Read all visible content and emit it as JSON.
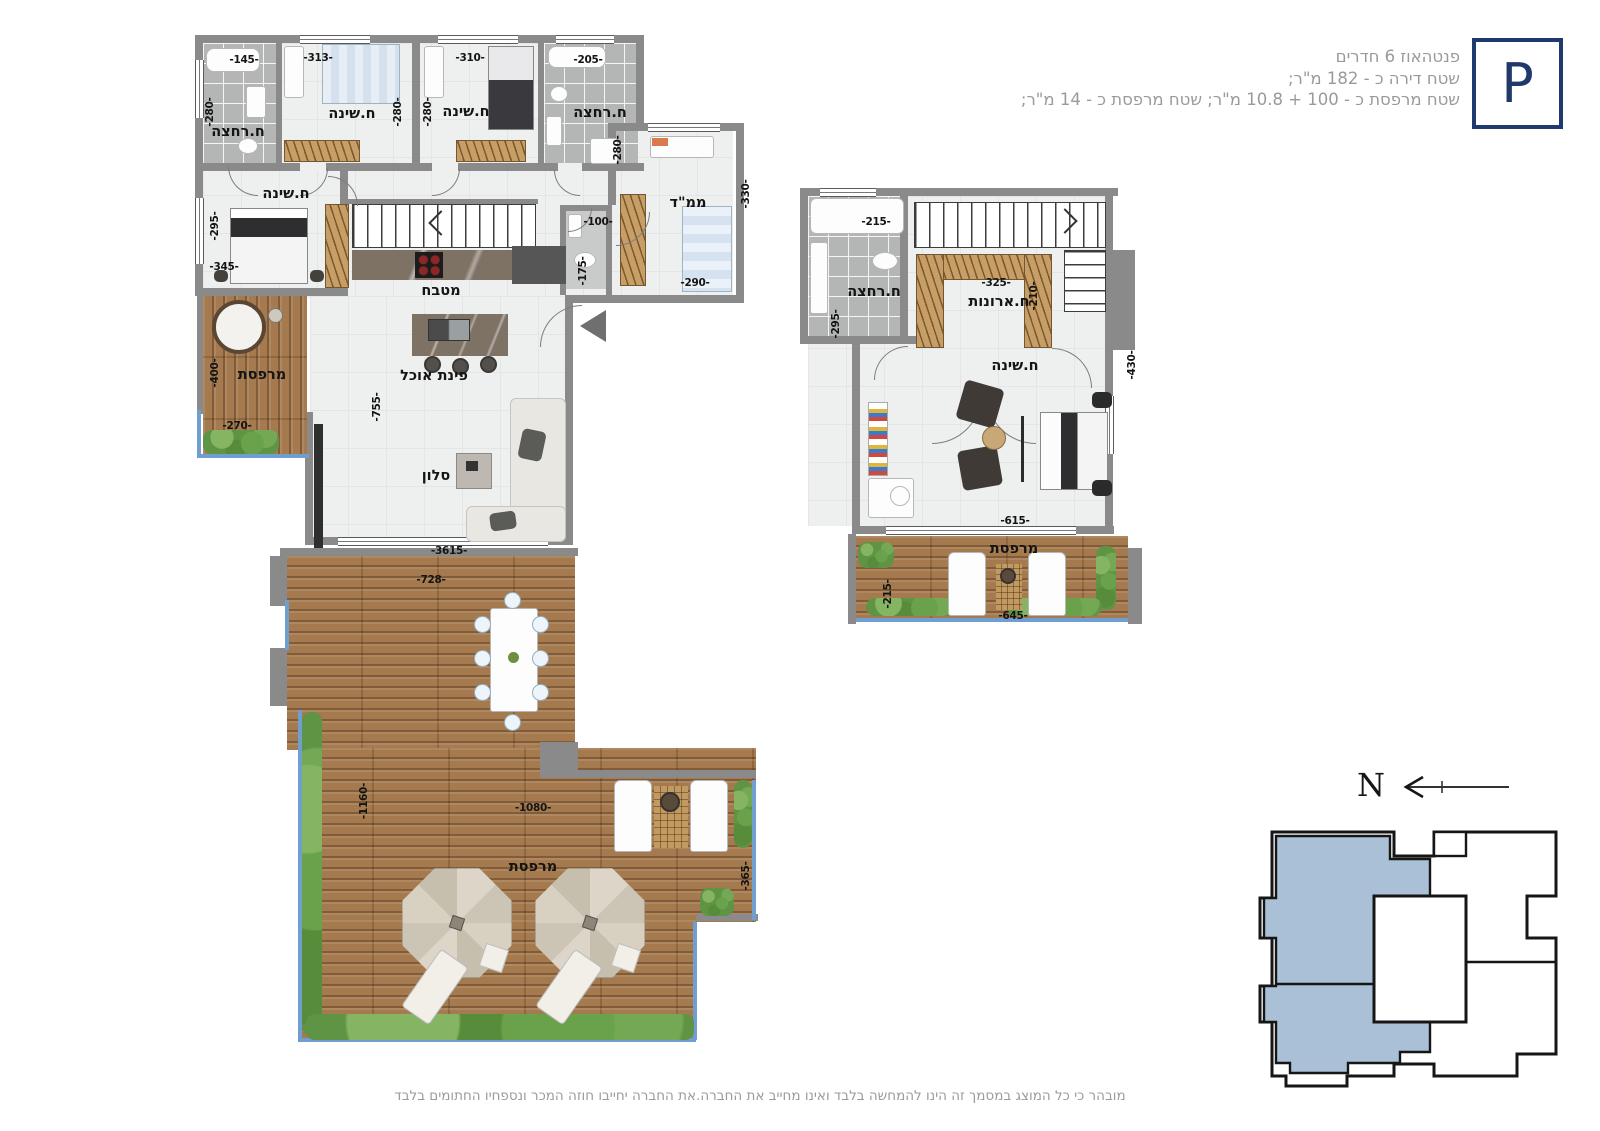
{
  "header": {
    "line1": "פנטהאוז 6 חדרים",
    "line2": "שטח דירה כ - 182 מ\"ר;",
    "line3": "שטח מרפסת כ - 100 + 10.8 מ\"ר; שטח מרפסת כ - 14 מ\"ר;",
    "logo": "P"
  },
  "f1": {
    "bath1": {
      "label": "ח.רחצה",
      "w": "-145-",
      "h": "-280-"
    },
    "bed1": {
      "label": "ח.שינה",
      "w": "-313-",
      "h": "-280-"
    },
    "bed2": {
      "label": "ח.שינה",
      "w": "-310-",
      "h": "-280-"
    },
    "bath2": {
      "label": "ח.רחצה",
      "w": "-205-",
      "h": "-280-"
    },
    "bed3": {
      "label": "ח.שינה",
      "h": "-295-",
      "w": "-345-"
    },
    "kitchen": {
      "label": "מטבח"
    },
    "dining": {
      "label": "פינת אוכל"
    },
    "salon": {
      "label": "סלון",
      "h": "-755-",
      "w": "-3615-"
    },
    "wc": {
      "w": "-100-",
      "h": "-175-"
    },
    "mamad": {
      "label": "ממ\"ד",
      "h": "-330-",
      "w": "-290-"
    },
    "balcony": {
      "label": "מרפסת",
      "h": "-400-",
      "w": "-270-"
    },
    "terrace": {
      "label": "מרפסת",
      "top": "-728-",
      "left": "-1160-",
      "mid": "-1080-",
      "right": "-365-"
    }
  },
  "f2": {
    "bath": {
      "label": "ח.רחצה",
      "w": "-215-",
      "h": "-295-"
    },
    "closet": {
      "label": "ח.ארונות",
      "w": "-325-",
      "h": "-210-"
    },
    "bedroom": {
      "label": "ח.שינה",
      "h": "-430-",
      "w": "-615-"
    },
    "balcony": {
      "label": "מרפסת",
      "h": "-215-",
      "w": "-645-"
    }
  },
  "keyplan": {
    "north": "N"
  },
  "footer": {
    "disclaimer": "מובהר כי כל המוצג במסמך זה הינו להמחשה בלבד ואינו מחייב את החברה.את החברה יחייבו חוזה המכר ונספחיו החתומים בלבד"
  },
  "colors": {
    "accent_navy": "#1e3a6e",
    "keyplan_blue": "#a9c0d6",
    "wall_gray": "#8a8a8a",
    "deck_wood": "#a57a4e",
    "hedge_green": "#5f9444",
    "railing_blue": "#6f9fd0",
    "text_gray": "#9a9a9a"
  }
}
